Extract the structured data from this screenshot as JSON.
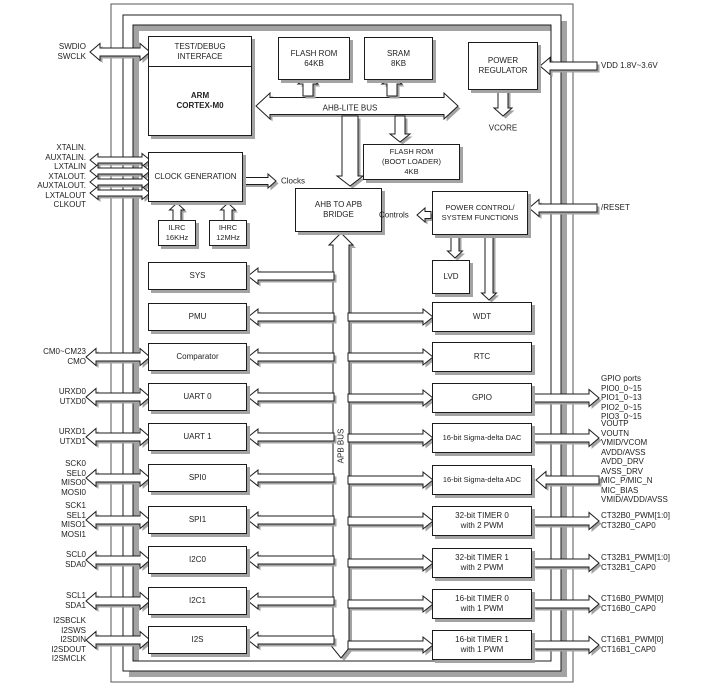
{
  "blocks": {
    "test_debug": "TEST/DEBUG\nINTERFACE",
    "cpu": "ARM\nCORTEX-M0",
    "flash": "FLASH ROM\n64KB",
    "sram": "SRAM\n8KB",
    "power_reg": "POWER\nREGULATOR",
    "boot_rom": "FLASH ROM\n(BOOT LOADER)\n4KB",
    "clock_gen": "CLOCK GENERATION",
    "ilrc": "ILRC\n16KHz",
    "ihrc": "IHRC\n12MHz",
    "bridge": "AHB TO APB\nBRIDGE",
    "power_ctrl": "POWER CONTROL/\nSYSTEM FUNCTIONS",
    "lvd": "LVD",
    "sys": "SYS",
    "pmu": "PMU",
    "comparator": "Comparator",
    "uart0": "UART 0",
    "uart1": "UART 1",
    "spi0": "SPI0",
    "spi1": "SPI1",
    "i2c0": "I2C0",
    "i2c1": "I2C1",
    "i2s": "I2S",
    "wdt": "WDT",
    "rtc": "RTC",
    "gpio": "GPIO",
    "dac": "16-bit Sigma-delta DAC",
    "adc": "16-bit Sigma-delta ADC",
    "t32_0": "32-bit TIMER 0\nwith 2 PWM",
    "t32_1": "32-bit TIMER 1\nwith 2 PWM",
    "t16_0": "16-bit TIMER 0\nwith 1 PWM",
    "t16_1": "16-bit TIMER 1\nwith 1 PWM"
  },
  "buses": {
    "ahb": "AHB-LITE BUS",
    "apb": "APB BUS",
    "clocks": "Clocks",
    "controls": "Controls",
    "vcore": "VCORE"
  },
  "pins_left": {
    "swd": [
      "SWDIO",
      "SWCLK"
    ],
    "xtal": [
      "XTALIN.",
      "AUXTALIN.",
      "LXTALIN",
      "XTALOUT.",
      "AUXTALOUT.",
      "LXTALOUT",
      "CLKOUT"
    ],
    "cmp": [
      "CM0~CM23",
      "CMO"
    ],
    "uart0": [
      "URXD0",
      "UTXD0"
    ],
    "uart1": [
      "URXD1",
      "UTXD1"
    ],
    "spi0": [
      "SCK0",
      "SEL0",
      "MISO0",
      "MOSI0"
    ],
    "spi1": [
      "SCK1",
      "SEL1",
      "MISO1",
      "MOSI1"
    ],
    "i2c0": [
      "SCL0",
      "SDA0"
    ],
    "i2c1": [
      "SCL1",
      "SDA1"
    ],
    "i2s": [
      "I2SBCLK",
      "I2SWS",
      "I2SDIN",
      "I2SDOUT",
      "I2SMCLK"
    ]
  },
  "pins_right": {
    "vdd": "VDD 1.8V~3.6V",
    "reset": "/RESET",
    "gpio": [
      "GPIO ports",
      "PIO0_0~15",
      "PIO1_0~13",
      "PIO2_0~15",
      "PIO3_0~15"
    ],
    "analog": [
      "VOUTP",
      "VOUTN",
      "VMID/VCOM",
      "AVDD/AVSS",
      "AVDD_DRV",
      "AVSS_DRV",
      "MIC_P/MIC_N",
      "MIC_BIAS",
      "VMID/AVDD/AVSS"
    ],
    "t32_0": [
      "CT32B0_PWM[1:0]",
      "CT32B0_CAP0"
    ],
    "t32_1": [
      "CT32B1_PWM[1:0]",
      "CT32B1_CAP0"
    ],
    "t16_0": [
      "CT16B0_PWM[0]",
      "CT16B0_CAP0"
    ],
    "t16_1": [
      "CT16B1_PWM[0]",
      "CT16B1_CAP0"
    ]
  },
  "colors": {
    "block_fill": "#ffffff",
    "stroke": "#1c1c1c",
    "shadow": "#a3a3a3",
    "text": "#222222"
  }
}
